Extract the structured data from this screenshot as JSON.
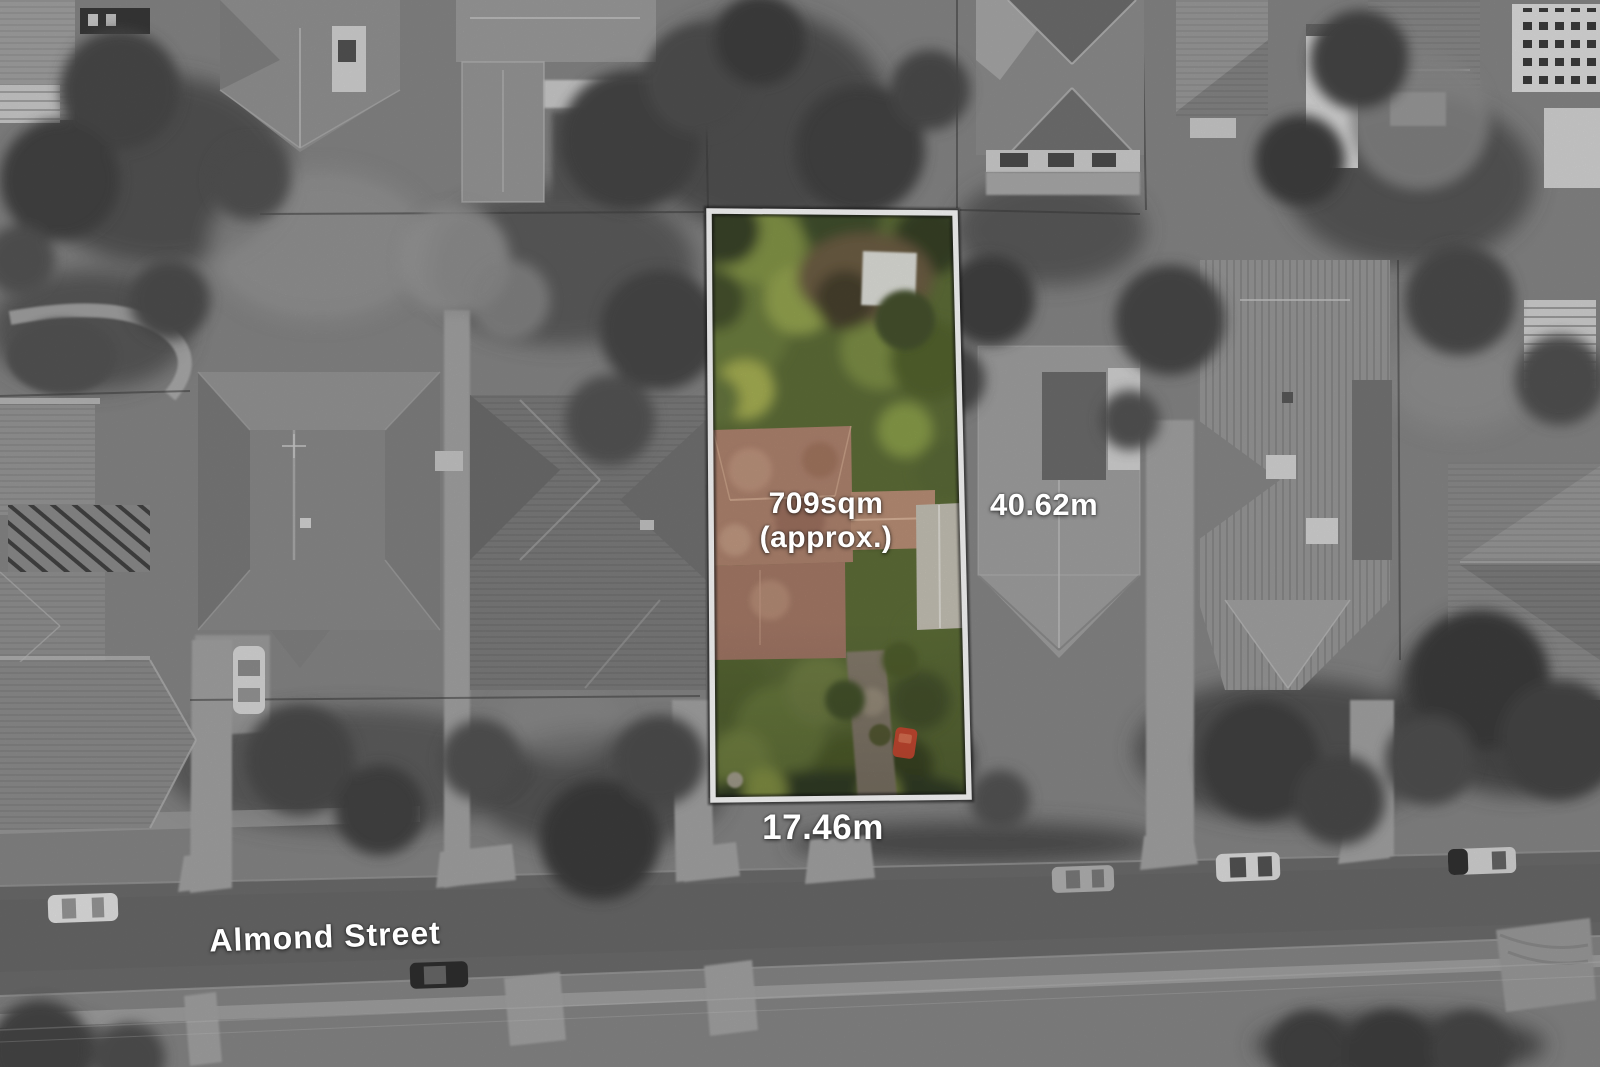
{
  "annotations": {
    "area": {
      "line1": "709sqm",
      "line2": "(approx.)"
    },
    "depth": "40.62m",
    "frontage": "17.46m",
    "street": "Almond Street"
  },
  "colors": {
    "label_text": "#ffffff",
    "parcel_border": "#ffffff",
    "parcel_green_base": "#5f6f39",
    "parcel_green_bright": "#8fa14b",
    "roof_terracotta": "#b28671",
    "red_car": "#d84f35",
    "road_gray": "#6e6e6e",
    "base_gray": "#898989"
  }
}
